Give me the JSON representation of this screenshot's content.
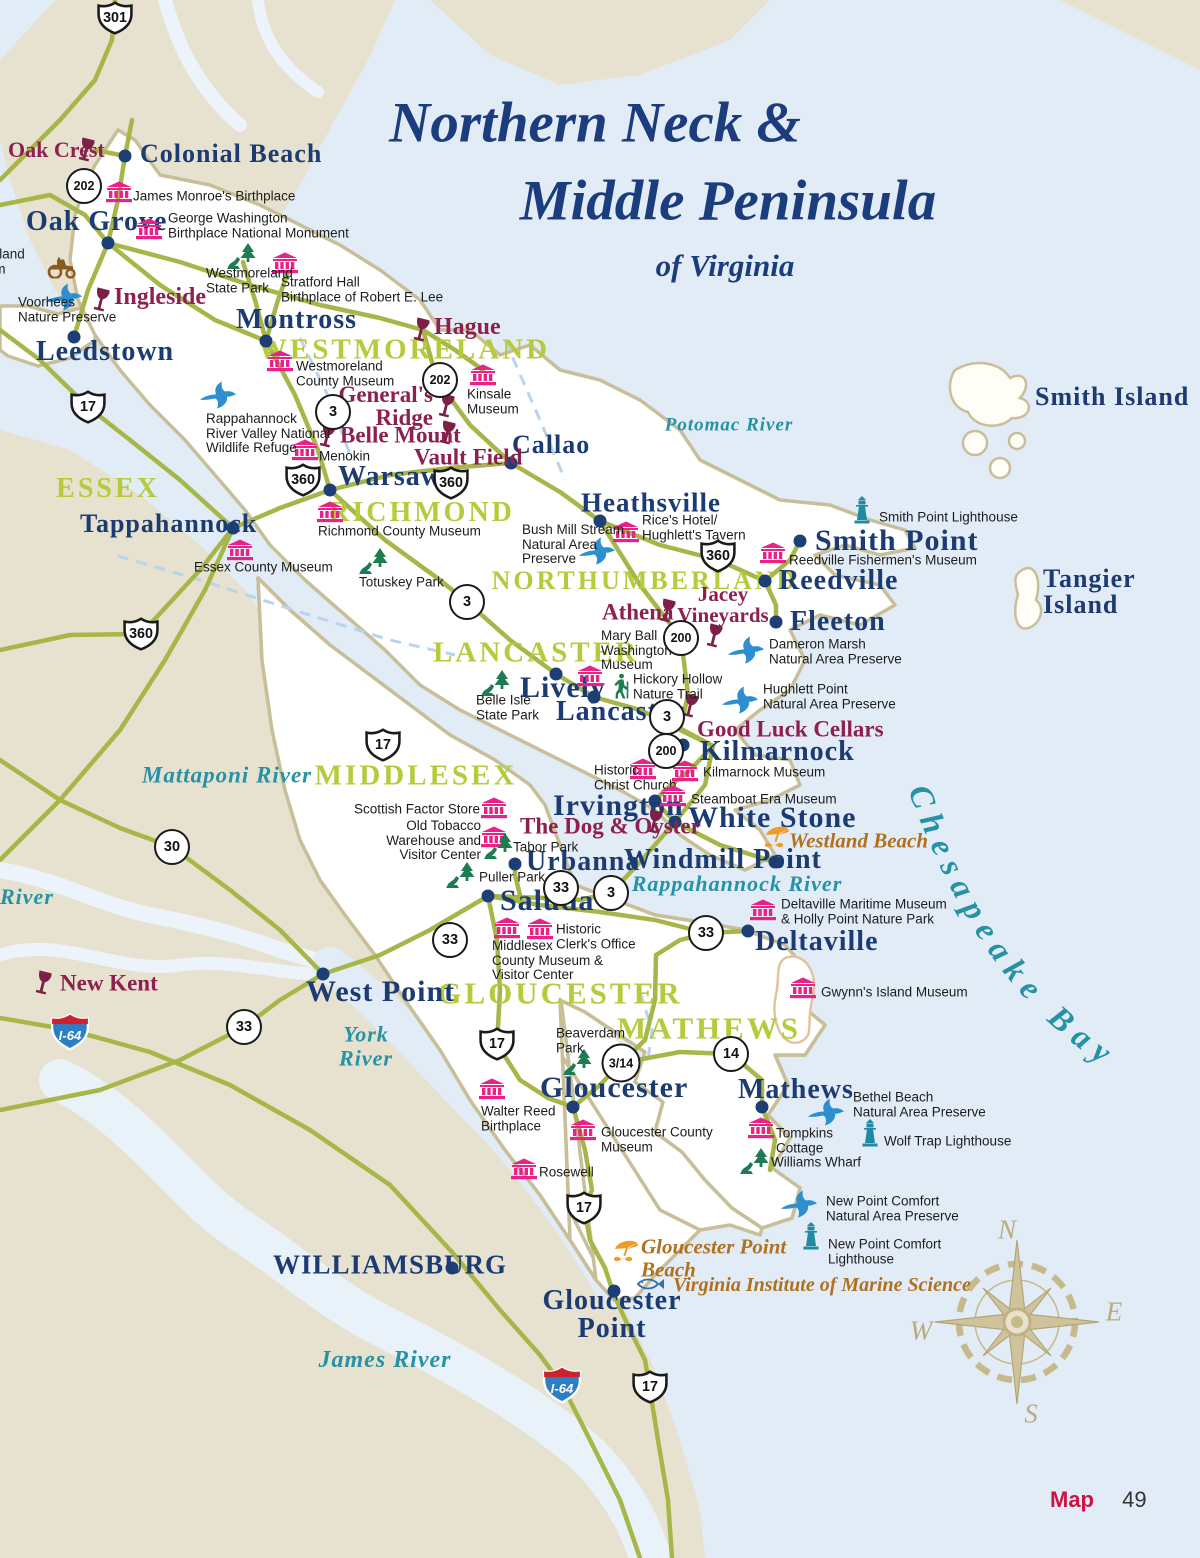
{
  "title": {
    "line1": "Northern Neck &",
    "line2": "Middle Peninsula",
    "subtitle": "of Virginia"
  },
  "footer": {
    "map_label": "Map",
    "page_number": "49"
  },
  "bay_label": "Chesapeake Bay",
  "compass": {
    "n": "N",
    "e": "E",
    "s": "S",
    "w": "W"
  },
  "colors": {
    "water": "#e2ecf7",
    "land_tan": "#e7e2cf",
    "land_focus": "#ffffff",
    "coast": "#c8bf99",
    "road": "#a6b648",
    "county_label": "#b5cb3b",
    "town_label": "#1c3b73",
    "museum_pink": "#e82289",
    "winery_maroon": "#8e2050",
    "park_green": "#1e7b52",
    "preserve_blue": "#2e8fd0",
    "lighthouse_teal": "#1f8ba3",
    "beach_gold": "#b1701d",
    "water_label": "#2592a6",
    "compass_tan": "#c6b98a",
    "map_red": "#cc1342",
    "interstate_blue": "#2d7fc4",
    "interstate_red": "#cf2030"
  },
  "routes": [
    {
      "k": "us",
      "n": "301",
      "x": 115,
      "y": 18
    },
    {
      "k": "us",
      "n": "17",
      "x": 88,
      "y": 407
    },
    {
      "k": "us",
      "n": "360",
      "x": 303,
      "y": 480
    },
    {
      "k": "us",
      "n": "360",
      "x": 451,
      "y": 483
    },
    {
      "k": "us",
      "n": "360",
      "x": 141,
      "y": 634
    },
    {
      "k": "us",
      "n": "360",
      "x": 718,
      "y": 556
    },
    {
      "k": "us",
      "n": "17",
      "x": 383,
      "y": 745
    },
    {
      "k": "us",
      "n": "17",
      "x": 497,
      "y": 1044
    },
    {
      "k": "us",
      "n": "17",
      "x": 584,
      "y": 1208
    },
    {
      "k": "us",
      "n": "17",
      "x": 650,
      "y": 1387
    },
    {
      "k": "state",
      "n": "202",
      "x": 84,
      "y": 186
    },
    {
      "k": "state",
      "n": "202",
      "x": 440,
      "y": 380
    },
    {
      "k": "state",
      "n": "3",
      "x": 333,
      "y": 412
    },
    {
      "k": "state",
      "n": "3",
      "x": 467,
      "y": 602
    },
    {
      "k": "state",
      "n": "200",
      "x": 681,
      "y": 638
    },
    {
      "k": "state",
      "n": "3",
      "x": 667,
      "y": 717
    },
    {
      "k": "state",
      "n": "200",
      "x": 666,
      "y": 751
    },
    {
      "k": "state",
      "n": "30",
      "x": 172,
      "y": 847
    },
    {
      "k": "state",
      "n": "33",
      "x": 561,
      "y": 888
    },
    {
      "k": "state",
      "n": "3",
      "x": 611,
      "y": 893
    },
    {
      "k": "state",
      "n": "33",
      "x": 450,
      "y": 940
    },
    {
      "k": "state",
      "n": "33",
      "x": 706,
      "y": 933
    },
    {
      "k": "state",
      "n": "33",
      "x": 244,
      "y": 1027
    },
    {
      "k": "state",
      "n": "3/14",
      "x": 621,
      "y": 1063
    },
    {
      "k": "state",
      "n": "14",
      "x": 731,
      "y": 1054
    },
    {
      "k": "interstate",
      "n": "I-64",
      "x": 70,
      "y": 1032
    },
    {
      "k": "interstate",
      "n": "I-64",
      "x": 562,
      "y": 1385
    }
  ],
  "markers": [
    {
      "t": "county",
      "l": "ESSEX",
      "x": 108,
      "y": 489,
      "a": "m",
      "s": 28
    },
    {
      "t": "county",
      "l": "WESTMORELAND",
      "x": 404,
      "y": 350,
      "a": "m",
      "s": 29
    },
    {
      "t": "county",
      "l": "RICHMOND",
      "x": 422,
      "y": 513,
      "a": "m",
      "s": 28
    },
    {
      "t": "county",
      "l": "NORTHUMBERLAND",
      "x": 645,
      "y": 581,
      "a": "m",
      "s": 26
    },
    {
      "t": "county",
      "l": "LANCASTER",
      "x": 536,
      "y": 653,
      "a": "m",
      "s": 29
    },
    {
      "t": "county",
      "l": "MIDDLESEX",
      "x": 416,
      "y": 776,
      "a": "m",
      "s": 29
    },
    {
      "t": "county",
      "l": "GLOUCESTER",
      "x": 560,
      "y": 993,
      "a": "m",
      "s": 31
    },
    {
      "t": "county",
      "l": "MATHEWS",
      "x": 709,
      "y": 1028,
      "a": "m",
      "s": 31
    },
    {
      "t": "water",
      "l": "Potomac River",
      "x": 729,
      "y": 426,
      "a": "m",
      "s": 19
    },
    {
      "t": "water",
      "l": "Mattaponi River",
      "x": 227,
      "y": 776,
      "a": "m",
      "s": 23
    },
    {
      "t": "water",
      "l": "Rappahannock River",
      "x": 737,
      "y": 884,
      "a": "m",
      "s": 22
    },
    {
      "t": "water",
      "l": "York\nRiver",
      "x": 366,
      "y": 1046,
      "a": "m",
      "s": 22
    },
    {
      "t": "water",
      "l": "James River",
      "x": 385,
      "y": 1361,
      "a": "m",
      "s": 24
    },
    {
      "t": "water",
      "l": "River",
      "x": 0,
      "y": 897,
      "a": "s",
      "s": 22
    },
    {
      "t": "town",
      "l": "Colonial Beach",
      "x": 140,
      "y": 154,
      "a": "s",
      "s": 26,
      "dot": [
        125,
        156
      ]
    },
    {
      "t": "town",
      "l": "Oak Grove",
      "x": 26,
      "y": 222,
      "a": "s",
      "s": 28,
      "dot": [
        108,
        243
      ]
    },
    {
      "t": "town",
      "l": "Montross",
      "x": 236,
      "y": 320,
      "a": "s",
      "s": 28,
      "dot": [
        266,
        341
      ]
    },
    {
      "t": "town",
      "l": "Leedstown",
      "x": 36,
      "y": 352,
      "a": "s",
      "s": 28,
      "dot": [
        74,
        337
      ]
    },
    {
      "t": "town",
      "l": "Tappahannock",
      "x": 80,
      "y": 524,
      "a": "s",
      "s": 26,
      "dot": [
        233,
        528
      ]
    },
    {
      "t": "town",
      "l": "Warsaw",
      "x": 338,
      "y": 477,
      "a": "s",
      "s": 28,
      "dot": [
        330,
        490
      ]
    },
    {
      "t": "town",
      "l": "Callao",
      "x": 512,
      "y": 445,
      "a": "s",
      "s": 26,
      "dot": [
        511,
        463
      ]
    },
    {
      "t": "town",
      "l": "Heathsville",
      "x": 581,
      "y": 503,
      "a": "s",
      "s": 27,
      "dot": [
        600,
        521
      ]
    },
    {
      "t": "town",
      "l": "Smith Point",
      "x": 815,
      "y": 541,
      "a": "s",
      "s": 30,
      "dot": [
        800,
        541
      ]
    },
    {
      "t": "town",
      "l": "Reedville",
      "x": 779,
      "y": 581,
      "a": "s",
      "s": 28,
      "dot": [
        765,
        581
      ]
    },
    {
      "t": "town",
      "l": "Fleeton",
      "x": 790,
      "y": 622,
      "a": "s",
      "s": 28,
      "dot": [
        776,
        622
      ]
    },
    {
      "t": "town",
      "l": "Lively",
      "x": 520,
      "y": 688,
      "a": "s",
      "s": 30,
      "dot": [
        556,
        674
      ]
    },
    {
      "t": "town",
      "l": "Lancaster",
      "x": 556,
      "y": 712,
      "a": "s",
      "s": 28,
      "dot": [
        594,
        697
      ]
    },
    {
      "t": "town",
      "l": "Kilmarnock",
      "x": 700,
      "y": 752,
      "a": "s",
      "s": 28,
      "dot": [
        683,
        745
      ]
    },
    {
      "t": "town",
      "l": "Irvington",
      "x": 553,
      "y": 806,
      "a": "s",
      "s": 30,
      "dot": [
        655,
        801
      ]
    },
    {
      "t": "town",
      "l": "White Stone",
      "x": 688,
      "y": 818,
      "a": "s",
      "s": 30,
      "dot": [
        675,
        822
      ]
    },
    {
      "t": "town",
      "l": "Windmill Point",
      "x": 624,
      "y": 860,
      "a": "s",
      "s": 28,
      "dot": [
        775,
        862
      ]
    },
    {
      "t": "town",
      "l": "Urbanna",
      "x": 526,
      "y": 862,
      "a": "s",
      "s": 28,
      "dot": [
        515,
        864
      ]
    },
    {
      "t": "town",
      "l": "Saluda",
      "x": 500,
      "y": 901,
      "a": "s",
      "s": 30,
      "dot": [
        488,
        896
      ]
    },
    {
      "t": "town",
      "l": "West Point",
      "x": 306,
      "y": 992,
      "a": "s",
      "s": 30,
      "dot": [
        323,
        974
      ]
    },
    {
      "t": "town",
      "l": "Deltaville",
      "x": 755,
      "y": 942,
      "a": "s",
      "s": 28,
      "dot": [
        748,
        931
      ]
    },
    {
      "t": "town",
      "l": "Gloucester",
      "x": 540,
      "y": 1088,
      "a": "s",
      "s": 30,
      "dot": [
        573,
        1107
      ]
    },
    {
      "t": "town",
      "l": "Mathews",
      "x": 738,
      "y": 1090,
      "a": "s",
      "s": 28,
      "dot": [
        762,
        1107
      ]
    },
    {
      "t": "town",
      "l": "WILLIAMSBURG",
      "x": 273,
      "y": 1265,
      "a": "s",
      "s": 27,
      "dot": [
        452,
        1268
      ]
    },
    {
      "t": "town",
      "l": "Gloucester\nPoint",
      "x": 612,
      "y": 1315,
      "a": "m",
      "s": 28,
      "dot": [
        614,
        1291
      ]
    },
    {
      "t": "town",
      "l": "Smith Island",
      "x": 1035,
      "y": 397,
      "a": "s",
      "s": 26
    },
    {
      "t": "town",
      "l": "Tangier Island",
      "x": 1043,
      "y": 592,
      "a": "s",
      "s": 26
    },
    {
      "t": "winery",
      "l": "Oak Crest",
      "x": 8,
      "y": 150,
      "a": "s",
      "s": 22,
      "ic": [
        86,
        151
      ]
    },
    {
      "t": "winery",
      "l": "Ingleside",
      "x": 114,
      "y": 297,
      "a": "s",
      "s": 24,
      "ic": [
        101,
        301
      ]
    },
    {
      "t": "winery",
      "l": "Hague",
      "x": 434,
      "y": 327,
      "a": "s",
      "s": 24,
      "ic": [
        421,
        331
      ]
    },
    {
      "t": "winery",
      "l": "General's\nRidge",
      "x": 433,
      "y": 406,
      "a": "e",
      "s": 23,
      "ic": [
        446,
        407
      ]
    },
    {
      "t": "winery",
      "l": "Belle Mount",
      "x": 340,
      "y": 435,
      "a": "s",
      "s": 23,
      "ic": [
        327,
        437
      ]
    },
    {
      "t": "winery",
      "l": "Vault Field",
      "x": 414,
      "y": 457,
      "a": "s",
      "s": 23,
      "ic": [
        447,
        434
      ]
    },
    {
      "t": "winery",
      "l": "Athena",
      "x": 602,
      "y": 612,
      "a": "s",
      "s": 23,
      "ic": [
        667,
        612
      ]
    },
    {
      "t": "winery",
      "l": "Jacey\nVineyards",
      "x": 723,
      "y": 605,
      "a": "m",
      "s": 21,
      "ic": [
        714,
        637
      ]
    },
    {
      "t": "winery",
      "l": "Good Luck Cellars",
      "x": 697,
      "y": 729,
      "a": "s",
      "s": 23,
      "ic": [
        690,
        707
      ]
    },
    {
      "t": "winery",
      "l": "The Dog & Oyster",
      "x": 520,
      "y": 826,
      "a": "s",
      "s": 23,
      "ic": [
        654,
        823
      ]
    },
    {
      "t": "winery",
      "l": "New Kent",
      "x": 60,
      "y": 983,
      "a": "s",
      "s": 23,
      "ic": [
        43,
        984
      ]
    },
    {
      "t": "museum",
      "l": "James Monroe's Birthplace",
      "x": 133,
      "y": 197,
      "a": "s",
      "ic": [
        119,
        192
      ]
    },
    {
      "t": "museum",
      "l": "George Washington\nBirthplace National Monument",
      "x": 168,
      "y": 226,
      "a": "s",
      "ic": [
        149,
        229
      ]
    },
    {
      "t": "museum",
      "l": "Stratford Hall\nBirthplace of Robert E. Lee",
      "x": 281,
      "y": 290,
      "a": "s",
      "ic": [
        285,
        263
      ]
    },
    {
      "t": "museum",
      "l": "Westmoreland\nCounty Museum",
      "x": 296,
      "y": 374,
      "a": "s",
      "ic": [
        280,
        361
      ]
    },
    {
      "t": "museum",
      "l": "Kinsale\nMuseum",
      "x": 467,
      "y": 402,
      "a": "s",
      "ic": [
        483,
        375
      ]
    },
    {
      "t": "museum",
      "l": "Menokin",
      "x": 319,
      "y": 457,
      "a": "s",
      "ic": [
        305,
        450
      ]
    },
    {
      "t": "museum",
      "l": "Richmond County Museum",
      "x": 318,
      "y": 532,
      "a": "s",
      "ic": [
        330,
        512
      ]
    },
    {
      "t": "museum",
      "l": "Essex County Museum",
      "x": 194,
      "y": 568,
      "a": "s",
      "ic": [
        240,
        550
      ]
    },
    {
      "t": "museum",
      "l": "Rice's Hotel/\nHughlett's Tavern",
      "x": 642,
      "y": 528,
      "a": "s",
      "ic": [
        626,
        532
      ]
    },
    {
      "t": "museum",
      "l": "Reedville Fishermen's Museum",
      "x": 789,
      "y": 561,
      "a": "s",
      "ic": [
        773,
        553
      ]
    },
    {
      "t": "museum",
      "l": "Mary Ball\nWashington\nMuseum",
      "x": 601,
      "y": 651,
      "a": "s",
      "ic": [
        590,
        676
      ]
    },
    {
      "t": "museum",
      "l": "Kilmarnock Museum",
      "x": 703,
      "y": 773,
      "a": "s",
      "ic": [
        685,
        771
      ]
    },
    {
      "t": "museum",
      "l": "Historic\nChrist Church",
      "x": 594,
      "y": 778,
      "a": "s",
      "ic": [
        643,
        769
      ]
    },
    {
      "t": "museum",
      "l": "Steamboat Era Museum",
      "x": 691,
      "y": 800,
      "a": "s",
      "ic": [
        673,
        796
      ]
    },
    {
      "t": "museum",
      "l": "Scottish Factor Store",
      "x": 480,
      "y": 810,
      "a": "e",
      "ic": [
        494,
        808
      ]
    },
    {
      "t": "museum",
      "l": "Old Tobacco\nWarehouse and\nVisitor Center",
      "x": 481,
      "y": 841,
      "a": "e",
      "ic": [
        494,
        837
      ]
    },
    {
      "t": "museum",
      "l": "Middlesex\nCounty Museum &\nVisitor Center",
      "x": 492,
      "y": 961,
      "a": "s",
      "ic": [
        507,
        928
      ]
    },
    {
      "t": "museum",
      "l": "Historic\nClerk's Office",
      "x": 556,
      "y": 937,
      "a": "s",
      "ic": [
        540,
        929
      ]
    },
    {
      "t": "museum",
      "l": "Deltaville Maritime Museum\n& Holly Point Nature Park",
      "x": 781,
      "y": 912,
      "a": "s",
      "ic": [
        763,
        910
      ]
    },
    {
      "t": "museum",
      "l": "Gwynn's Island Museum",
      "x": 821,
      "y": 993,
      "a": "s",
      "ic": [
        803,
        988
      ]
    },
    {
      "t": "museum",
      "l": "Walter Reed\nBirthplace",
      "x": 481,
      "y": 1119,
      "a": "s",
      "ic": [
        492,
        1089
      ]
    },
    {
      "t": "museum",
      "l": "Gloucester County\nMuseum",
      "x": 601,
      "y": 1140,
      "a": "s",
      "ic": [
        583,
        1130
      ]
    },
    {
      "t": "museum",
      "l": "Rosewell",
      "x": 539,
      "y": 1173,
      "a": "s",
      "ic": [
        524,
        1169
      ]
    },
    {
      "t": "museum",
      "l": "Tompkins\nCottage",
      "x": 776,
      "y": 1141,
      "a": "s",
      "ic": [
        761,
        1128
      ]
    },
    {
      "t": "park",
      "l": "Westmoreland\nState Park",
      "x": 206,
      "y": 281,
      "a": "s",
      "ic": [
        242,
        256
      ]
    },
    {
      "t": "park",
      "l": "Totuskey Park",
      "x": 359,
      "y": 583,
      "a": "s",
      "ic": [
        374,
        561
      ]
    },
    {
      "t": "park",
      "l": "Belle Isle\nState Park",
      "x": 476,
      "y": 708,
      "a": "s",
      "ic": [
        496,
        683
      ]
    },
    {
      "t": "park",
      "l": "Tabor Park",
      "x": 513,
      "y": 848,
      "a": "s",
      "ic": [
        499,
        846
      ]
    },
    {
      "t": "park",
      "l": "Puller Park",
      "x": 479,
      "y": 878,
      "a": "s",
      "ic": [
        461,
        875
      ]
    },
    {
      "t": "park",
      "l": "Beaverdam\nPark",
      "x": 556,
      "y": 1041,
      "a": "s",
      "ic": [
        578,
        1062
      ]
    },
    {
      "t": "park",
      "l": "Williams Wharf",
      "x": 771,
      "y": 1163,
      "a": "s",
      "ic": [
        755,
        1161
      ]
    },
    {
      "t": "preserve",
      "l": "Voorhees\nNature Preserve",
      "x": 18,
      "y": 310,
      "a": "s",
      "ic": [
        64,
        297
      ]
    },
    {
      "t": "preserve",
      "l": "Rappahannock\nRiver Valley National\nWildlife Refuge",
      "x": 206,
      "y": 434,
      "a": "s",
      "ic": [
        218,
        395
      ]
    },
    {
      "t": "preserve",
      "l": "Bush Mill Stream\nNatural Area\nPreserve",
      "x": 522,
      "y": 545,
      "a": "s",
      "ic": [
        597,
        551
      ]
    },
    {
      "t": "preserve",
      "l": "Dameron Marsh\nNatural Area Preserve",
      "x": 769,
      "y": 652,
      "a": "s",
      "ic": [
        746,
        650
      ]
    },
    {
      "t": "preserve",
      "l": "Hughlett Point\nNatural Area Preserve",
      "x": 763,
      "y": 697,
      "a": "s",
      "ic": [
        740,
        700
      ]
    },
    {
      "t": "preserve",
      "l": "Bethel Beach\nNatural Area Preserve",
      "x": 853,
      "y": 1105,
      "a": "s",
      "ic": [
        826,
        1112
      ]
    },
    {
      "t": "preserve",
      "l": "New Point Comfort\nNatural Area Preserve",
      "x": 826,
      "y": 1209,
      "a": "s",
      "ic": [
        799,
        1204
      ]
    },
    {
      "t": "lighthouse",
      "l": "Smith Point Lighthouse",
      "x": 879,
      "y": 518,
      "a": "s",
      "ic": [
        862,
        511
      ]
    },
    {
      "t": "lighthouse",
      "l": "Wolf Trap Lighthouse",
      "x": 884,
      "y": 1142,
      "a": "s",
      "ic": [
        870,
        1134
      ]
    },
    {
      "t": "lighthouse",
      "l": "New Point Comfort\nLighthouse",
      "x": 828,
      "y": 1252,
      "a": "s",
      "ic": [
        811,
        1237
      ]
    },
    {
      "t": "trail",
      "l": "Hickory Hollow\nNature Trail",
      "x": 633,
      "y": 687,
      "a": "s",
      "ic": [
        621,
        686
      ]
    },
    {
      "t": "beach",
      "l": "Westland Beach",
      "x": 789,
      "y": 841,
      "a": "s",
      "s": 21,
      "ic": [
        777,
        837
      ]
    },
    {
      "t": "beach",
      "l": "Gloucester Point\nBeach",
      "x": 641,
      "y": 1258,
      "a": "s",
      "s": 21,
      "ic": [
        626,
        1251
      ]
    },
    {
      "t": "vims",
      "l": "Virginia Institute of Marine Science",
      "x": 673,
      "y": 1286,
      "a": "s",
      "s": 20,
      "ic": [
        650,
        1284
      ]
    },
    {
      "t": "farm",
      "l": "Westmoreland\nBerry Farm",
      "x": -62,
      "y": 262,
      "a": "s",
      "ic": [
        62,
        268
      ]
    }
  ]
}
